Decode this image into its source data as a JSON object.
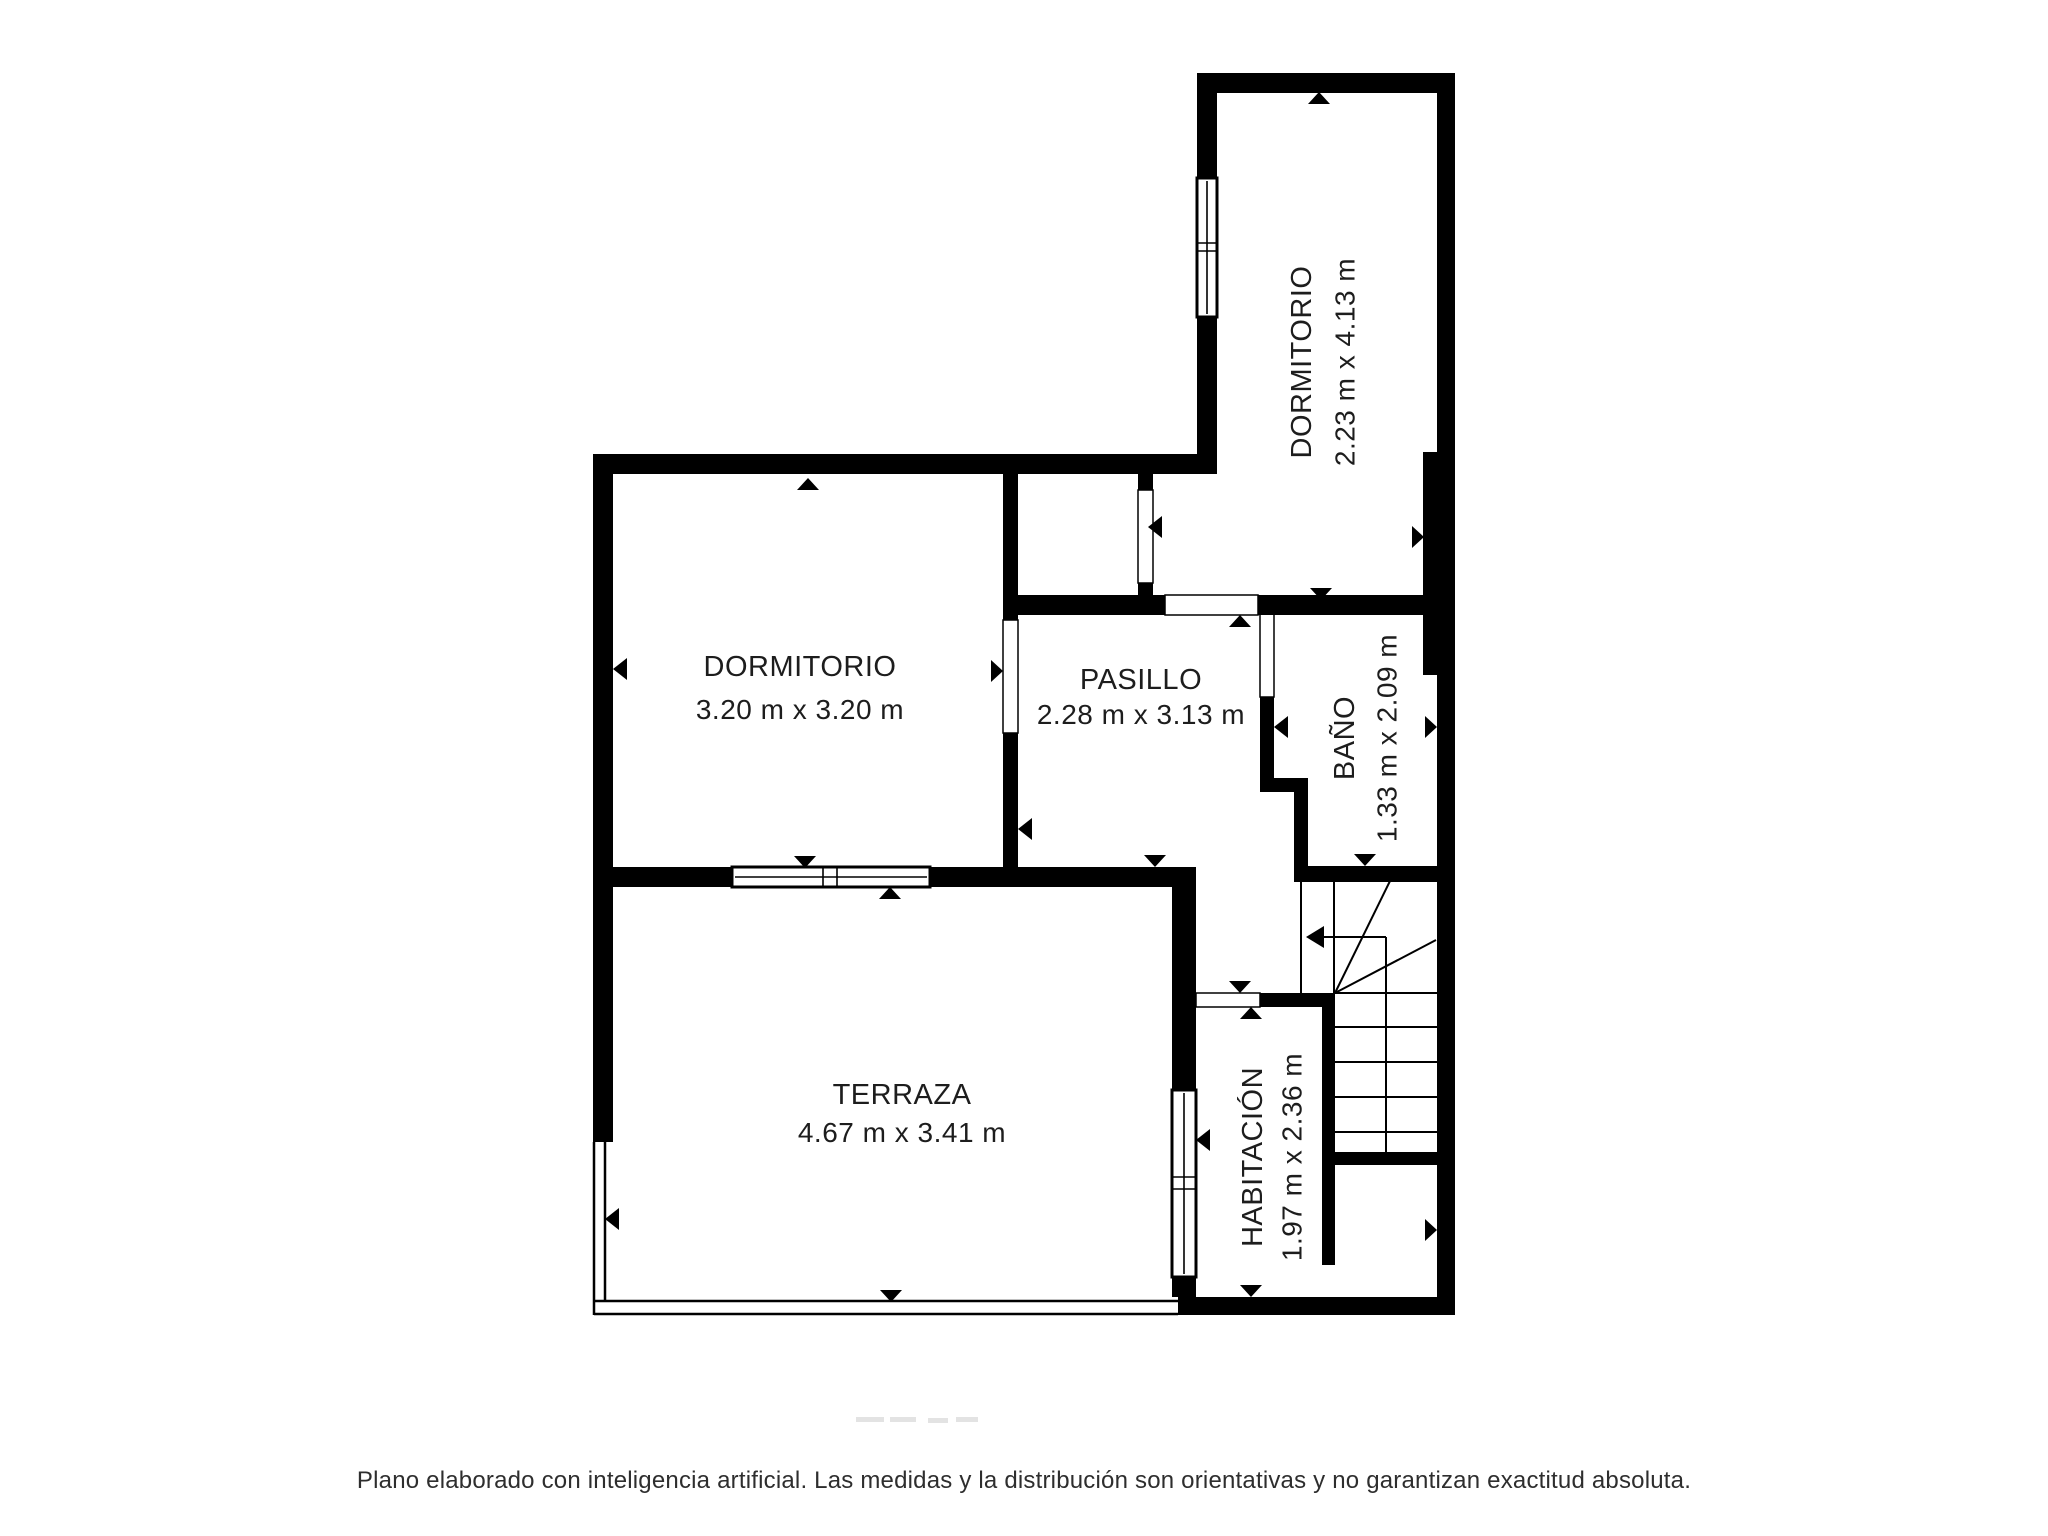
{
  "plan": {
    "title": "Plano de planta",
    "rooms": [
      {
        "id": "dormitorio-superior",
        "name": "DORMITORIO",
        "dims": "2.23 m x 4.13 m",
        "orientation": "vertical"
      },
      {
        "id": "dormitorio-izquierdo",
        "name": "DORMITORIO",
        "dims": "3.20 m x 3.20 m",
        "orientation": "horizontal"
      },
      {
        "id": "pasillo",
        "name": "PASILLO",
        "dims": "2.28 m x 3.13 m",
        "orientation": "horizontal"
      },
      {
        "id": "bano",
        "name": "BAÑO",
        "dims": "1.33 m x 2.09 m",
        "orientation": "vertical"
      },
      {
        "id": "terraza",
        "name": "TERRAZA",
        "dims": "4.67 m x 3.41 m",
        "orientation": "horizontal"
      },
      {
        "id": "habitacion",
        "name": "HABITACIÓN",
        "dims": "1.97 m x 2.36 m",
        "orientation": "vertical"
      }
    ],
    "features": [
      "escalera",
      "ventanas",
      "puertas",
      "terraza con barandilla"
    ]
  },
  "footer": {
    "disclaimer": "Plano elaborado con inteligencia artificial. Las medidas y la distribución son orientativas y no garantizan exactitud absoluta."
  },
  "colors": {
    "wall": "#000000",
    "background": "#ffffff",
    "text": "#1d1d1d",
    "footer_text": "#2e2e2e"
  }
}
